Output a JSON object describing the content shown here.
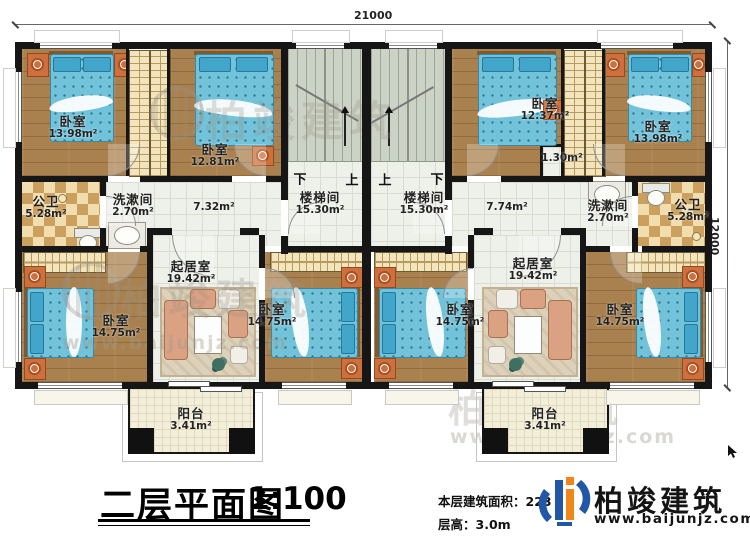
{
  "meta": {
    "title": "二层平面图",
    "scale": "1:100",
    "area_note_label": "本层建筑面积：",
    "area_note_value": "223",
    "floor_height": "层高：3.0m"
  },
  "logo": {
    "name": "柏竣建筑",
    "url": "www.baijunjz.com"
  },
  "watermark": {
    "text": "柏竣建筑",
    "url": "www.baijunjz.com"
  },
  "dimensions": {
    "top": "21000",
    "right": "12000"
  },
  "stairs": {
    "left": {
      "name": "楼梯间",
      "area": "15.30m²",
      "left_mark": "下",
      "right_mark": "上"
    },
    "right": {
      "name": "楼梯间",
      "area": "15.30m²",
      "left_mark": "上",
      "right_mark": "下"
    }
  },
  "rooms": {
    "bedroom_tl": {
      "name": "卧室",
      "area": "13.98m²"
    },
    "bedroom_l2": {
      "name": "卧室",
      "area": "12.81m²"
    },
    "bath_l": {
      "name": "公卫",
      "area": "5.28m²"
    },
    "wash_l": {
      "name": "洗漱间",
      "area": "2.70m²"
    },
    "hall_l": {
      "area": "7.32m²"
    },
    "hall_r": {
      "area": "7.74m²"
    },
    "closet_r": {
      "area": "1.30m²"
    },
    "bedroom_r2": {
      "name": "卧室",
      "area": "12.37m²"
    },
    "bedroom_tr": {
      "name": "卧室",
      "area": "13.98m²"
    },
    "wash_r": {
      "name": "洗漱间",
      "area": "2.70m²"
    },
    "bath_r": {
      "name": "公卫",
      "area": "5.28m²"
    },
    "bedroom_bl": {
      "name": "卧室",
      "area": "14.75m²"
    },
    "living_l": {
      "name": "起居室",
      "area": "19.42m²"
    },
    "bedroom_bml": {
      "name": "卧室",
      "area": "14.75m²"
    },
    "bedroom_bmr": {
      "name": "卧室",
      "area": "14.75m²"
    },
    "living_r": {
      "name": "起居室",
      "area": "19.42m²"
    },
    "bedroom_br": {
      "name": "卧室",
      "area": "14.75m²"
    },
    "balcony_l": {
      "name": "阳台",
      "area": "3.41m²"
    },
    "balcony_r": {
      "name": "阳台",
      "area": "3.41m²"
    }
  }
}
